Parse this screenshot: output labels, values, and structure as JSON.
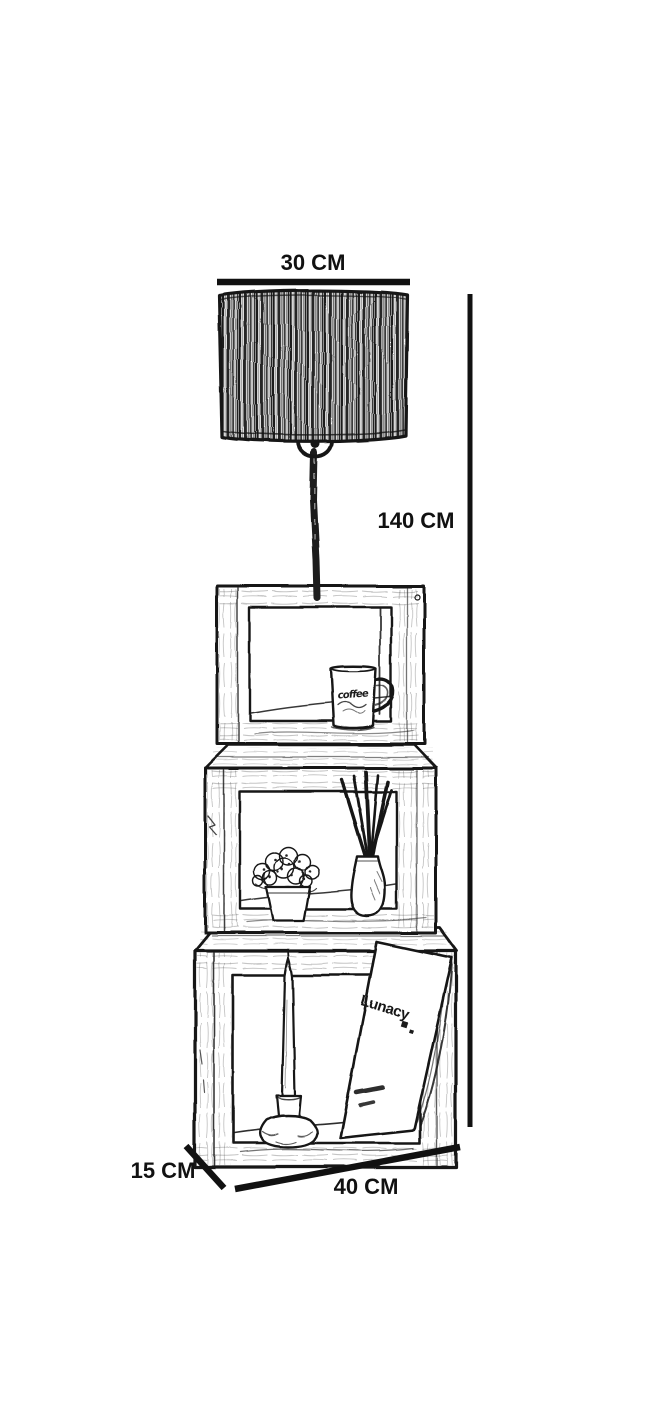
{
  "canvas": {
    "background": "#ffffff",
    "ink": "#161616"
  },
  "dimension_labels": {
    "shade_width": "30 CM",
    "height": "140 CM",
    "depth": "15 CM",
    "width": "40 CM"
  },
  "decor": {
    "mug_label": "coffee",
    "book_title": "Lunacy"
  }
}
